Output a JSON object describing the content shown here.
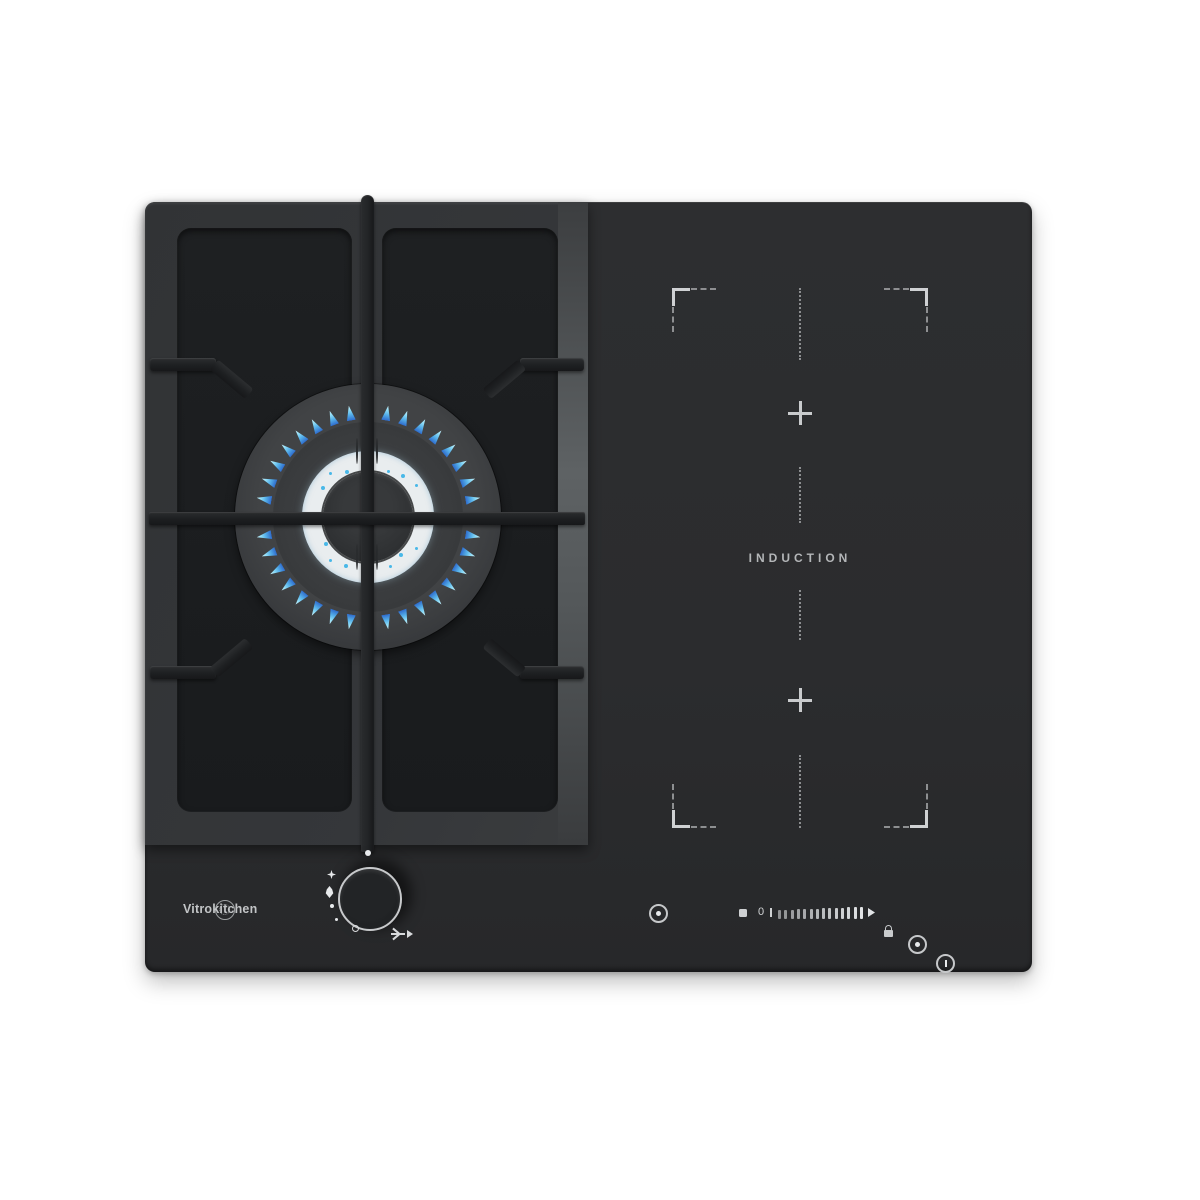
{
  "brand": {
    "logo_text": "Vitrokitchen"
  },
  "induction_zone": {
    "label": "INDUCTION",
    "plus_symbol": "+",
    "zones": [
      "flex-upper",
      "flex-lower"
    ]
  },
  "touch_controls": {
    "zero_label": "0",
    "icons": [
      "power-icon",
      "stop-square-icon",
      "power-slider",
      "lock-icon",
      "timer-icon",
      "pause-icon"
    ]
  },
  "knob": {
    "glyphs": [
      "off-dot",
      "spark-igniter",
      "large-flame",
      "small-flame-dot",
      "min-dot",
      "position-ring",
      "turn-arrow"
    ]
  },
  "visual": {
    "outer_flame_count": 36,
    "inner_speck_count": 22,
    "slider_bar_count": 14
  },
  "colors": {
    "background": "#ffffff",
    "glass": "#2b2c2e",
    "gas_frame": "#35373a",
    "inner_panel": "#1b1d1f",
    "flame_cyan": "#8fdcf6",
    "flame_blue": "#2e6bcc",
    "white_ring": "#e9edef",
    "marking_gray": "#b4b6b8",
    "knob_ring": "#c7c9cb"
  }
}
